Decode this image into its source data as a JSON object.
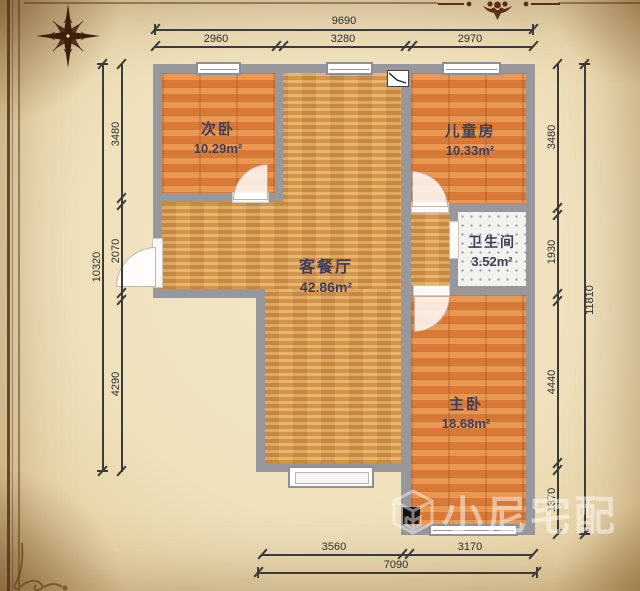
{
  "page": {
    "type": "apartment-floor-plan"
  },
  "rooms": [
    {
      "key": "second-bedroom",
      "name": "次卧",
      "area": "10.29m²"
    },
    {
      "key": "children-room",
      "name": "儿童房",
      "area": "10.33m²"
    },
    {
      "key": "bathroom",
      "name": "卫生间",
      "area": "3.52m²"
    },
    {
      "key": "living-dining",
      "name": "客餐厅",
      "area": "42.86m²"
    },
    {
      "key": "master-bedroom",
      "name": "主卧",
      "area": "18.68m²"
    }
  ],
  "dimensions": {
    "top_total": "9690",
    "top_segments": [
      "2960",
      "3280",
      "2970"
    ],
    "left_total": "10320",
    "left_segments": [
      "3480",
      "2070",
      "4290"
    ],
    "right_total": "11810",
    "right_segments": [
      "3480",
      "1930",
      "4440",
      "1370"
    ],
    "bottom_total": "7090",
    "bottom_segments": [
      "3560",
      "3170"
    ]
  },
  "watermark": {
    "text": "小尼宅配"
  },
  "icons": {
    "compass": "compass-rose",
    "ornament": "floral-ornament",
    "appliance": "wall-appliance",
    "logo": "cube-logo"
  },
  "colors": {
    "wall": "#98979b",
    "living_floor": "#d9994a",
    "bedroom_floor": "#e08440",
    "bath_floor": "#f2f2ee",
    "parchment": "#efe1bc",
    "frame_brown": "#53341c",
    "dim_text": "#2e2e2e",
    "label_text": "#3e3e57",
    "watermark_white": "rgba(255,255,255,0.5)"
  }
}
